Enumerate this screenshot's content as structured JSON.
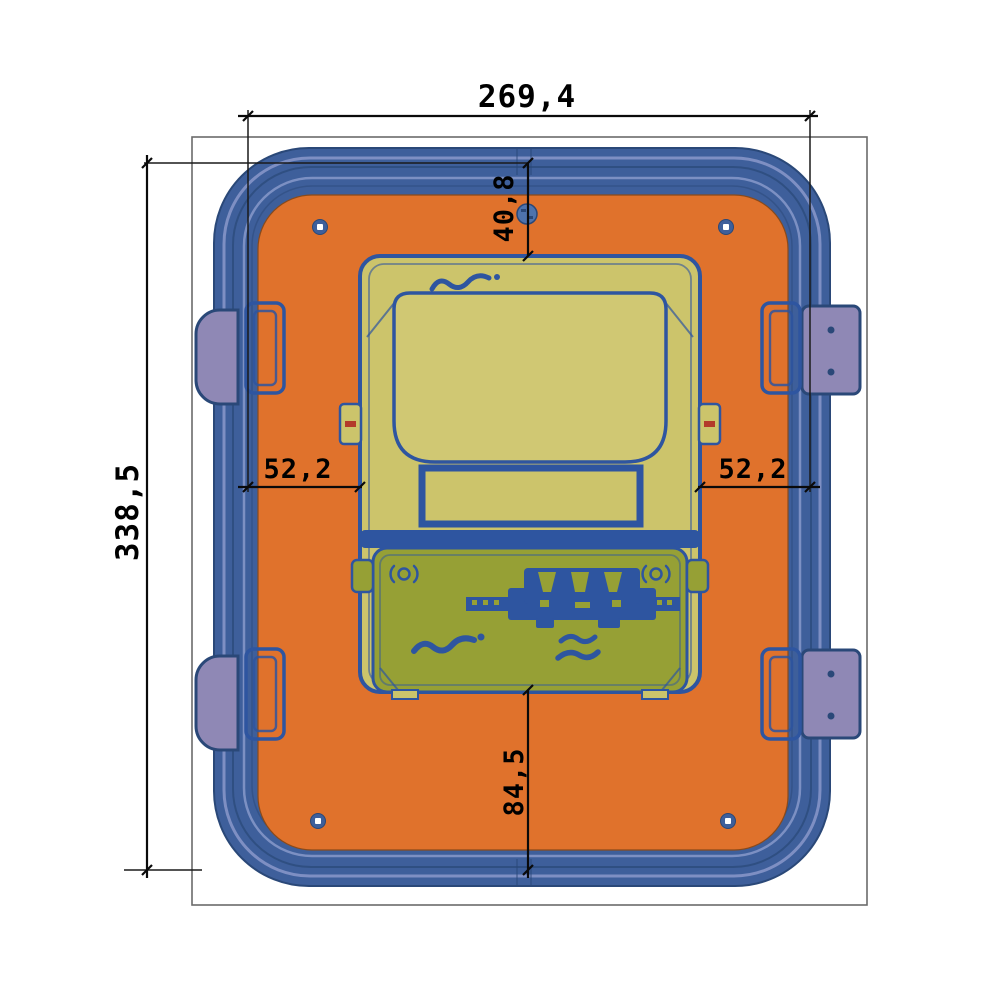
{
  "dimensions": {
    "overall_width": "269,4",
    "overall_height": "338,5",
    "meter_top_offset": "40,8",
    "meter_left_offset": "52,2",
    "meter_right_offset": "52,2",
    "meter_bottom_offset": "84,5"
  },
  "colors": {
    "enclosure_blue": "#3E5F9B",
    "rim_highlight": "#8998CA",
    "panel_orange": "#E0722C",
    "latch_purple": "#8F88B5",
    "meter_face_yellow": "#CCC46B",
    "meter_lower_olive": "#96A035",
    "device_outline_blue": "#2E55A0",
    "dimension_line_black": "#0A0A0A"
  }
}
